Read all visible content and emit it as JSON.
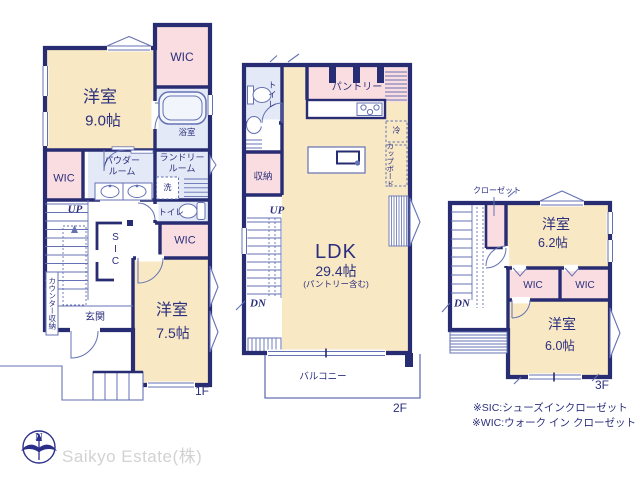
{
  "palette": {
    "wall": "#282c72",
    "room_beige": "#f8e8c4",
    "closet_pink": "#fadde0",
    "wet_blue": "#e3e9f6",
    "line_blue": "#6472b4",
    "text_navy": "#2b2f7e",
    "logo_gray": "#d2d2d2"
  },
  "floor1": {
    "floor_label": "1F",
    "room_west_name": "洋室",
    "room_west_size": "9.0帖",
    "wic_north": "WIC",
    "bath": "浴室",
    "powder_1": "パウダー",
    "powder_2": "ルーム",
    "laundry_1": "ランドリー",
    "laundry_2": "ルーム",
    "washer": "洗",
    "wic_west": "WIC",
    "up": "UP",
    "toilet": "トイレ",
    "wic_center": "WIC",
    "sic": "SIC",
    "room_south_name": "洋室",
    "room_south_size": "7.5帖",
    "entrance": "玄関",
    "counter_storage": "カウンター収納"
  },
  "floor2": {
    "floor_label": "2F",
    "toilet": "トイレ",
    "pantry": "パントリー",
    "fridge": "冷",
    "cupboard": "カップボード",
    "storage": "収納",
    "up": "UP",
    "dn": "DN",
    "ldk_name": "LDK",
    "ldk_size": "29.4帖",
    "ldk_note": "(パントリー含む)",
    "balcony": "バルコニー"
  },
  "floor3": {
    "floor_label": "3F",
    "closet": "クローゼット",
    "dn": "DN",
    "room_ne_name": "洋室",
    "room_ne_size": "6.2帖",
    "wic_west": "WIC",
    "wic_east": "WIC",
    "room_se_name": "洋室",
    "room_se_size": "6.0帖"
  },
  "notes": {
    "sic": "※SIC:シューズインクローゼット",
    "wic": "※WIC:ウォーク イン クローゼット"
  },
  "branding": {
    "company": "Saikyo Estate(株)",
    "compass_north": "N"
  }
}
